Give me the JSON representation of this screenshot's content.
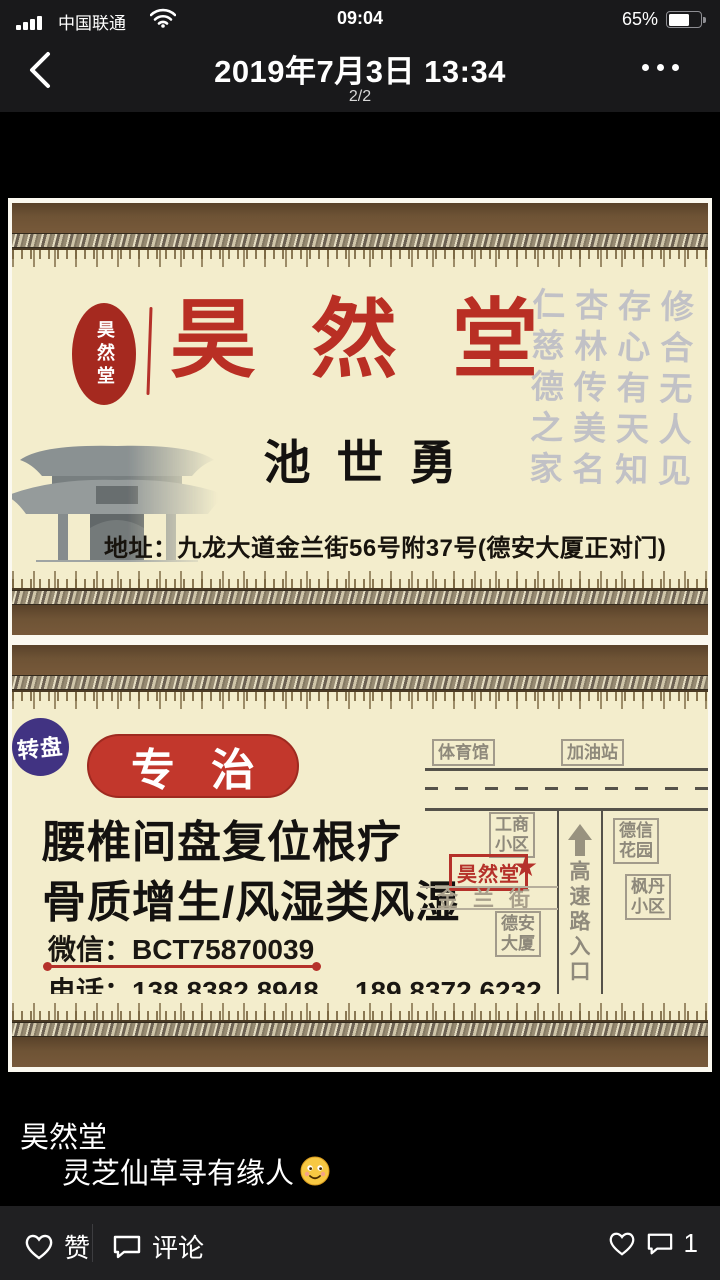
{
  "status_bar": {
    "carrier": "中国联通",
    "time": "09:04",
    "battery": "65%"
  },
  "nav": {
    "title": "2019年7月3日 13:34",
    "page_indicator": "2/2"
  },
  "card_front": {
    "seal_text": "昊然堂",
    "brand_chars": [
      "昊",
      "然",
      "堂"
    ],
    "calligraphy": "修合无人见\n存心有天知\n杏林传美名\n仁慈德之家",
    "person_name": "池世勇",
    "address": "地址：九龙大道金兰街56号附37号(德安大厦正对门)"
  },
  "card_back": {
    "badge": "专治",
    "specialty_line1": "腰椎间盘复位根疗",
    "specialty_line2": "骨质增生/风湿类风湿",
    "wechat_label": "微信：",
    "wechat_id": "BCT75870039",
    "phone_label": "电话：",
    "phone1": "138 8382 8948",
    "phone2": "189 8372 6232",
    "map": {
      "stadium": "体育馆",
      "gas_station": "加油站",
      "roundabout": "转盘",
      "industry_block": "工商\n小区",
      "clinic": "昊然堂",
      "star": "★",
      "jinlan_street": "金兰街",
      "dean_building": "德安\n大厦",
      "dexin_garden": "德信\n花园",
      "fengdan_block": "枫丹\n小区",
      "highway_entrance": "高速路入口"
    }
  },
  "caption": {
    "line1": "昊然堂",
    "line2": "灵芝仙草寻有缘人"
  },
  "toolbar": {
    "like_label": "赞",
    "comment_label": "评论",
    "comment_count": "1"
  },
  "colors": {
    "accent_red": "#b5312a",
    "badge_red": "#c2372c",
    "frame_brown": "#6e5335",
    "card_cream": "#f3edcc",
    "roundabout_purple": "#413382"
  }
}
